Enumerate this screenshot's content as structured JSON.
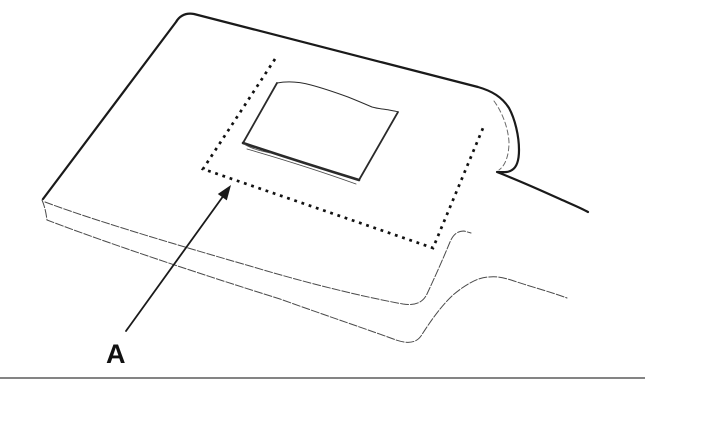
{
  "diagram": {
    "type": "technical-line-drawing",
    "description": "Flat pad shown in perspective with a layered lower edge and a tail extending to the right; a dotted border region on its top surface encloses a peeled-back patch; a leader arrow from label A points to the dotted border; a horizontal divider rule runs under the figure.",
    "callout": {
      "label": "A",
      "target": "dotted-region-border"
    },
    "colors": {
      "background": "#ffffff",
      "outline": "#1a1a1a",
      "thin_edge": "#4a4a4a",
      "hidden_edge": "#6a6a6a",
      "dotted_region": "#111111",
      "patch_line": "#2a2a2a",
      "divider": "#3a3a3a",
      "label": "#111111"
    }
  }
}
